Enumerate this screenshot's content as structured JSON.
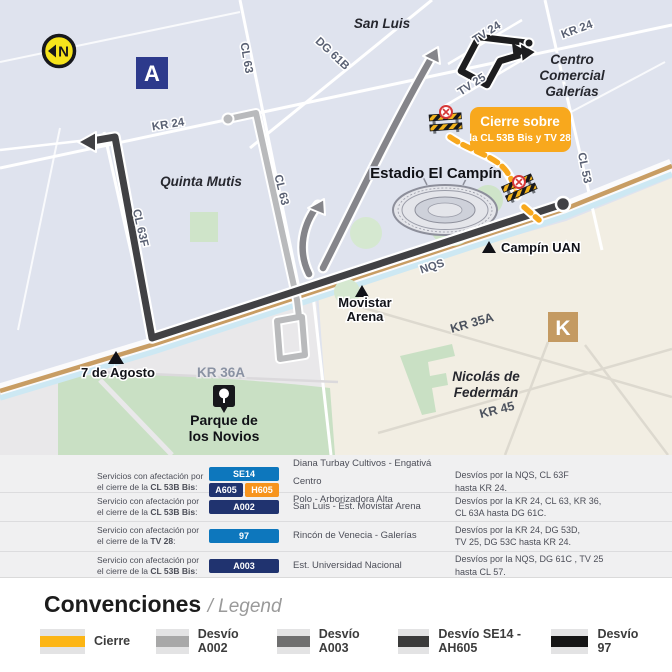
{
  "colors": {
    "cierre_yellow": "#F8A81D",
    "legend_cierre": "#FCB515",
    "desvio_a002_gray": "#B9BABC",
    "desvio_a003_gray": "#85858A",
    "desvio_se14_dark": "#414144",
    "desvio_97_black": "#1D1D1F",
    "badge_blue": "#0D77BD",
    "badge_navy": "#20336F",
    "badge_orange": "#F7941D",
    "zone_a_blue": "#2D3A8C",
    "zone_k_tan": "#C49A62",
    "north_yellow": "#F6E41C",
    "map_bg": "#DFE3EE",
    "district_beige": "#F2EEE3",
    "park_green": "#C9E0C4",
    "road_tan": "#C89D63",
    "canal_blue": "#CDE8F3"
  },
  "map": {
    "labels": {
      "north": "N",
      "a_zone": "A",
      "k_zone": "K",
      "san_luis": "San Luis",
      "tv24": "TV 24",
      "tv25": "TV 25",
      "kr24_ne": "KR 24",
      "kr24_w": "KR 24",
      "galerias_1": "Centro",
      "galerias_2": "Comercial",
      "galerias_3": "Galerías",
      "dg61b": "DG 61B",
      "cl63_n": "CL 63",
      "cl63_s": "CL 63",
      "cl63f": "CL 63F",
      "cl53": "CL 53",
      "quinta_mutis": "Quinta Mutis",
      "estadio": "Estadio El Campín",
      "campin_uan": "Campín UAN",
      "nqs": "NQS",
      "movistar_1": "Movistar",
      "movistar_2": "Arena",
      "kr35a": "KR 35A",
      "kr36a": "KR 36A",
      "kr45": "KR 45",
      "siete_agosto": "7 de Agosto",
      "federman_1": "Nicolás de",
      "federman_2": "Federmán",
      "parque_1": "Parque de",
      "parque_2": "los Novios"
    },
    "closure_box": {
      "line1": "Cierre sobre",
      "line2": "la CL 53B Bis y TV 28"
    }
  },
  "table": {
    "rows": [
      {
        "line1": "Servicios con afectación por",
        "line2_pre": "el cierre de la ",
        "line2_bold": "CL 53B Bis",
        "line2_post": ":",
        "badges": [
          {
            "label": "SE14"
          },
          {
            "label": "A605"
          },
          {
            "label": "H605"
          }
        ],
        "routes": [
          "Diana Turbay Cultivos - Engativá Centro",
          "Polo - Arborizadora Alta"
        ],
        "detour": [
          "Desvíos por la NQS, CL 63F",
          "hasta KR 24."
        ]
      },
      {
        "line1": "Servicio con afectación por",
        "line2_pre": "el cierre de la ",
        "line2_bold": "CL 53B Bis",
        "line2_post": ":",
        "badges": [
          {
            "label": "A002"
          }
        ],
        "routes": [
          "San Luis - Est. Movistar Arena"
        ],
        "detour": [
          "Desvíos por la KR 24, CL 63, KR 36,",
          "CL 63A hasta DG 61C."
        ]
      },
      {
        "line1": "Servicio con afectación por",
        "line2_pre": "el cierre de la ",
        "line2_bold": "TV 28",
        "line2_post": ":",
        "badges": [
          {
            "label": "97"
          }
        ],
        "routes": [
          "Rincón de Venecia - Galerías"
        ],
        "detour": [
          "Desvíos por la KR 24, DG 53D,",
          "TV 25, DG 53C hasta KR 24."
        ]
      },
      {
        "line1": "Servicio con afectación por",
        "line2_pre": "el cierre de la ",
        "line2_bold": "CL 53B Bis",
        "line2_post": ":",
        "badges": [
          {
            "label": "A003"
          }
        ],
        "routes": [
          "Est. Universidad Nacional"
        ],
        "detour": [
          "Desvíos por la NQS, DG 61C , TV 25",
          "hasta CL 57."
        ]
      }
    ]
  },
  "legend": {
    "title": "Convenciones",
    "subtitle": "/ Legend",
    "items": [
      {
        "label": "Cierre"
      },
      {
        "label": "Desvío A002"
      },
      {
        "label": "Desvío A003"
      },
      {
        "label": "Desvío SE14 - AH605"
      },
      {
        "label": "Desvío 97"
      }
    ]
  }
}
